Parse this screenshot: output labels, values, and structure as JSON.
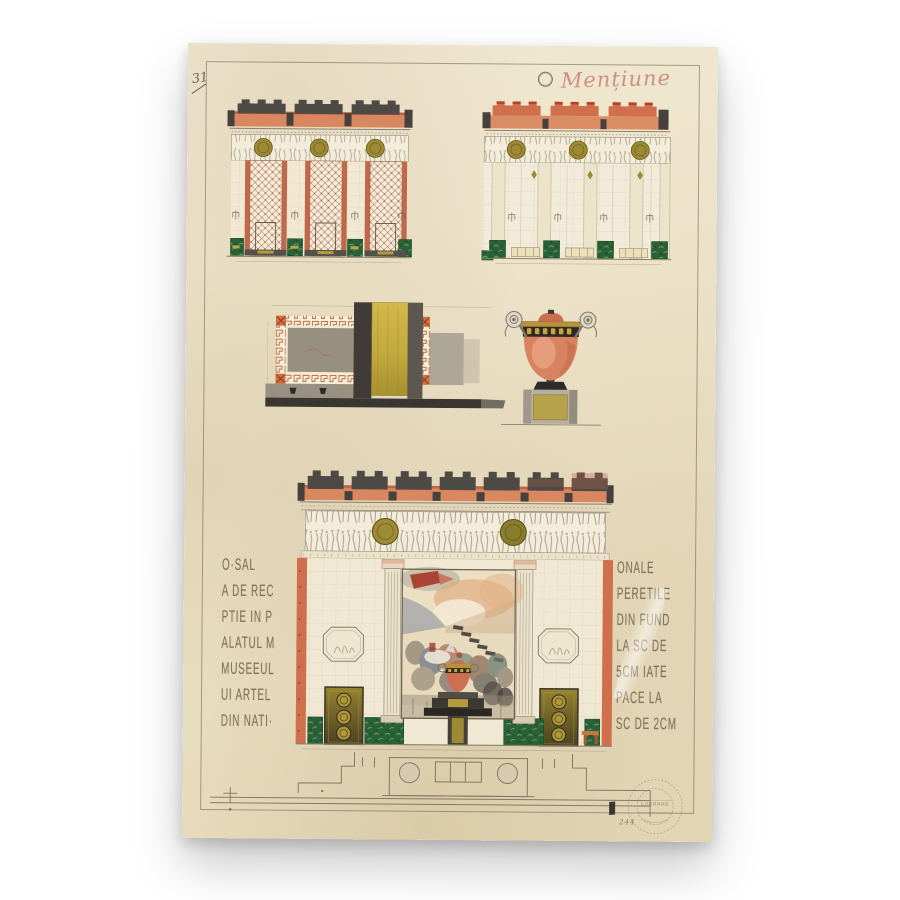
{
  "sheet": {
    "page_number": "31",
    "award_inscription": "Mențiune"
  },
  "annotations": {
    "left_lines": [
      "O·SAL",
      "A DE REC",
      "PTIE IN P",
      "ALATUL M",
      "MUSEEUL",
      "UI ARTEL",
      "DIN NATI·"
    ],
    "right_lines": [
      "ONALE",
      "PERETILE",
      "DIN FUND",
      "LA SC DE",
      "5CM IATE",
      "PACE LA",
      "SC DE 2CM"
    ]
  },
  "stamp": {
    "text": "LUCRARE",
    "pencil_note": "244"
  },
  "colors": {
    "paper": "#ece1c6",
    "pencil": "#6d6455",
    "red_ink": "#c8857a",
    "orange_band": "#d8875f",
    "vermilion": "#b5472f",
    "slate_crenellation": "#4d4a45",
    "gold_medallion": "#9d8a35",
    "bright_gold": "#c9ae4a",
    "green_marble": "#2b6136",
    "terracotta_vase": "#d9825f",
    "frieze_cream": "#f3ecd8"
  }
}
